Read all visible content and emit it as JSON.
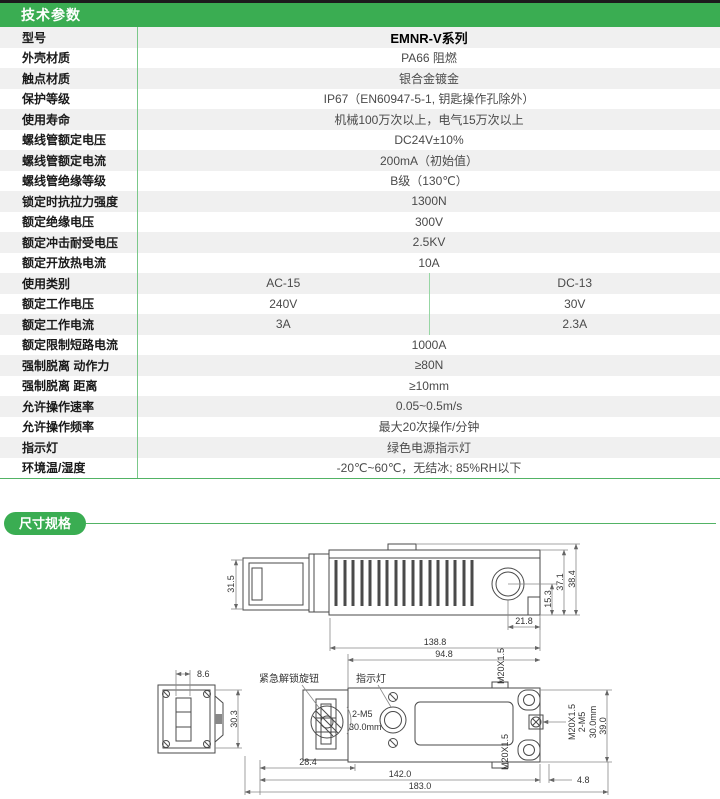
{
  "tech": {
    "title": "技术参数",
    "rows": [
      {
        "label": "型号",
        "value": "EMNR-V系列"
      },
      {
        "label": "外壳材质",
        "value": "PA66 阻燃"
      },
      {
        "label": "触点材质",
        "value": "银合金镀金"
      },
      {
        "label": "保护等级",
        "value": "IP67（EN60947-5-1, 钥匙操作孔除外）"
      },
      {
        "label": "使用寿命",
        "value": "机械100万次以上，电气15万次以上"
      },
      {
        "label": "螺线管额定电压",
        "value": "DC24V±10%"
      },
      {
        "label": "螺线管额定电流",
        "value": "200mA（初始值）"
      },
      {
        "label": "螺线管绝缘等级",
        "value": "B级（130℃）"
      },
      {
        "label": "锁定时抗拉力强度",
        "value": "1300N"
      },
      {
        "label": "额定绝缘电压",
        "value": "300V"
      },
      {
        "label": "额定冲击耐受电压",
        "value": "2.5KV"
      },
      {
        "label": "额定开放热电流",
        "value": "10A"
      },
      {
        "label": "使用类别",
        "ac": "AC-15",
        "dc": "DC-13"
      },
      {
        "label": "额定工作电压",
        "ac": "240V",
        "dc": "30V"
      },
      {
        "label": "额定工作电流",
        "ac": "3A",
        "dc": "2.3A"
      },
      {
        "label": "额定限制短路电流",
        "value": "1000A"
      },
      {
        "label": "强制脱离 动作力",
        "value": "≥80N"
      },
      {
        "label": "强制脱离 距离",
        "value": "≥10mm"
      },
      {
        "label": "允许操作速率",
        "value": "0.05~0.5m/s"
      },
      {
        "label": "允许操作频率",
        "value": "最大20次操作/分钟"
      },
      {
        "label": "指示灯",
        "value": "绿色电源指示灯"
      },
      {
        "label": "环境温/湿度",
        "value": "-20℃~60℃，无结冰; 85%RH以下"
      }
    ]
  },
  "dims": {
    "title": "尺寸规格",
    "side_view": {
      "head_height": "31.5",
      "center_to_bottom": "15.3",
      "body_height": "37.1",
      "total_height": "38.4",
      "circle_offset": "21.8"
    },
    "front_view": {
      "body_length": "138.8",
      "hole_span": "94.8",
      "slot_width": "8.6",
      "head_height": "30.3",
      "head_offset": "28.4",
      "mount_span": "142.0",
      "total_length": "183.0",
      "end_offset": "4.8",
      "body_height": "39.0",
      "gland_top": "M20X1.5",
      "gland_bottom": "M20X1.5",
      "gland_side": "M20X1.5",
      "screw_spec": "2-M5",
      "screw_depth": "30.0mm",
      "side_screw_spec": "2-M5",
      "side_screw_depth": "30.0mm",
      "label_knob": "紧急解锁旋钮",
      "label_led": "指示灯"
    }
  },
  "theme": {
    "green": "#3aad52",
    "divider_green": "#7bc88a",
    "row_alt": "#f0f0f0"
  }
}
